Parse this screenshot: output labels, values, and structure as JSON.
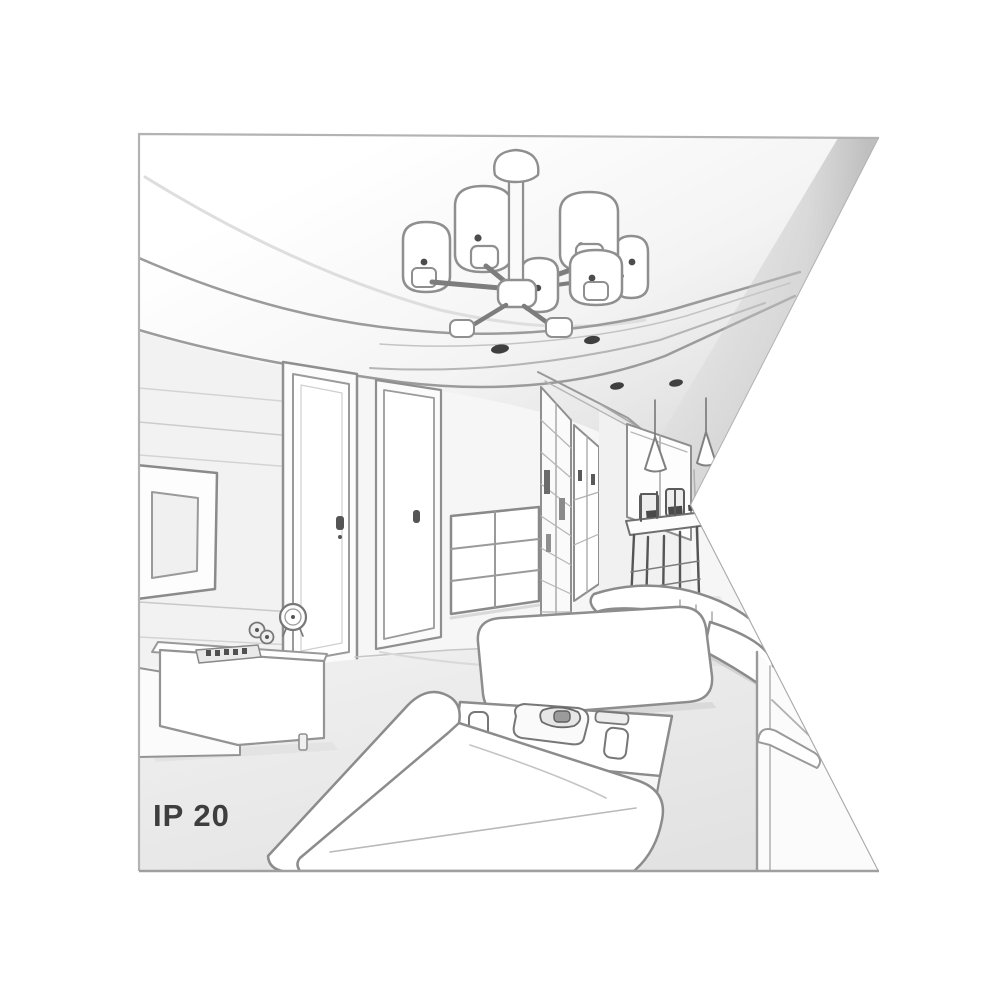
{
  "illustration": {
    "ip_rating": "IP 20",
    "type": "interior perspective line sketch",
    "room": "living room with hallway and dining nook, right edge cut by white wedge",
    "objects": [
      "six-shade-chandelier",
      "tray-ceiling-with-spotlights",
      "wall-tv-on-slatted-panel",
      "sideboard-with-clock-speaker-and-remote",
      "interior-door-near",
      "interior-door-far",
      "chest-of-drawers",
      "lattice-wardrobe",
      "hallway-cabinet",
      "back-window",
      "two-cone-pendant-lights",
      "dining-table-with-chairs",
      "ottoman-bench",
      "coffee-table-with-tray-and-cups",
      "corner-sofa-foreground",
      "right-sofa"
    ],
    "counts": {
      "chandelier_shades": 6,
      "ceiling_spotlights": 4,
      "pendant_lights": 2,
      "doors": 2
    },
    "colors": {
      "line": "#8d8d8d",
      "line_dark": "#4c4c4c",
      "line_soft": "#c8c8c8",
      "fill": "#ffffff",
      "wall": "#f5f5f5",
      "floor": "#eaeaea",
      "shadow": "#d8d8d8",
      "border": "#b3b3b3",
      "text": "#3e3e3e"
    }
  }
}
